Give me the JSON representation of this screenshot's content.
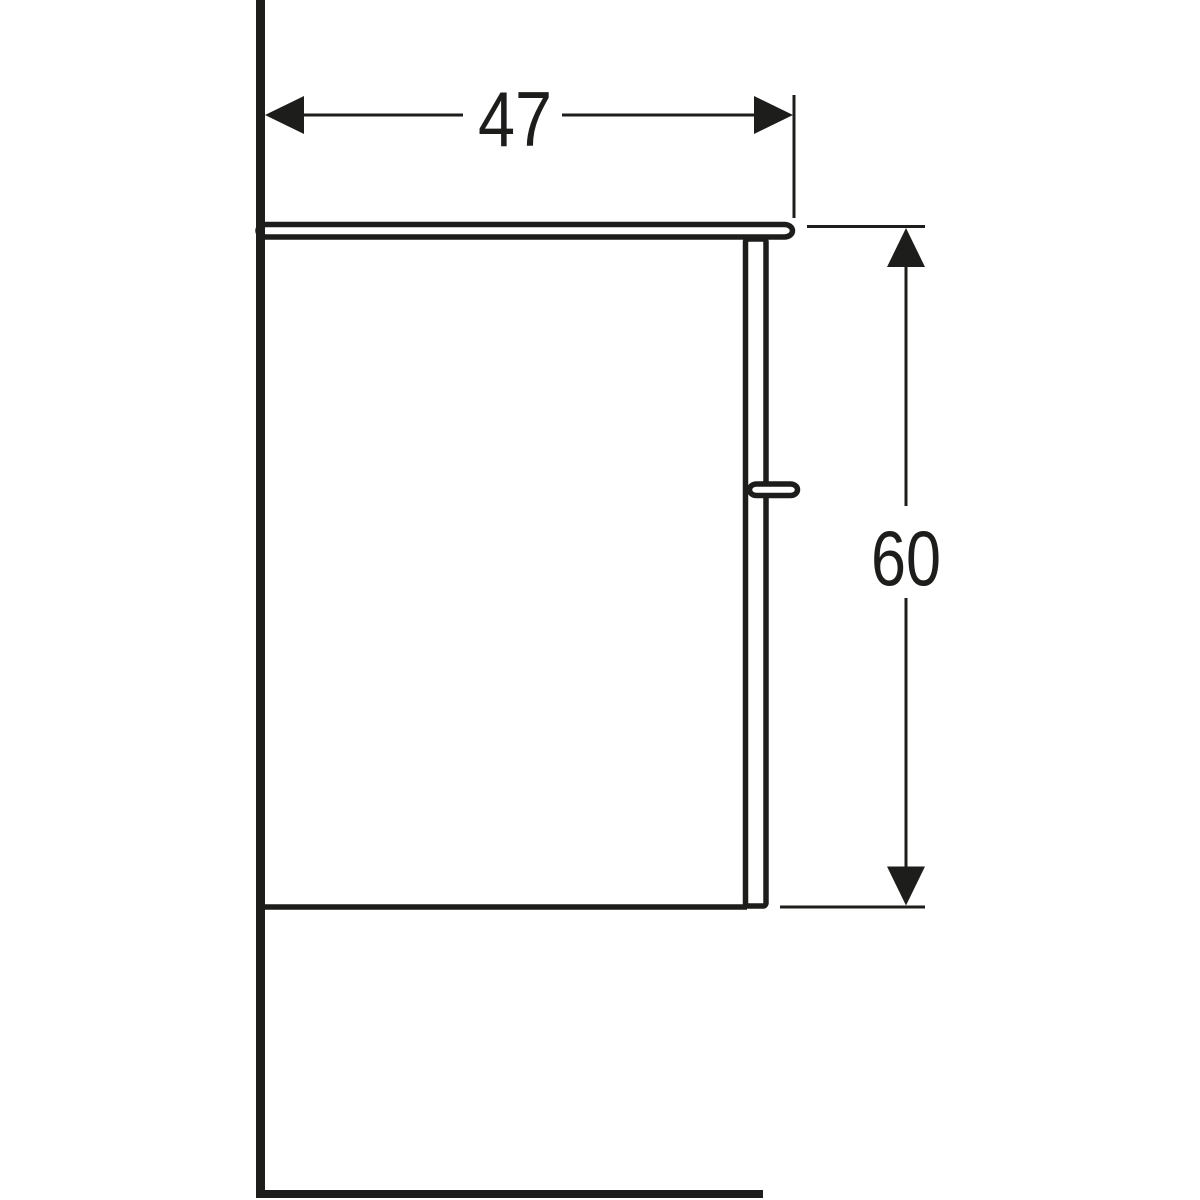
{
  "drawing": {
    "background_color": "#ffffff",
    "line_color": "#1d1d1b",
    "dimensions": {
      "width": {
        "label": "47",
        "orientation": "horizontal"
      },
      "height": {
        "label": "60",
        "orientation": "vertical"
      }
    }
  }
}
